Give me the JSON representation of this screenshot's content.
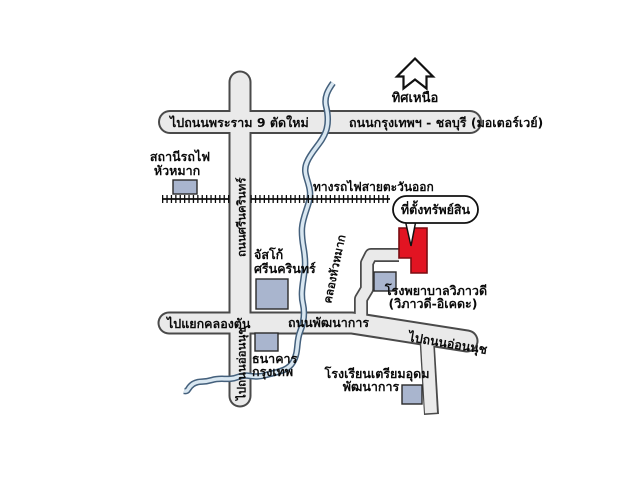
{
  "compass": {
    "label": "ทิศเหนือ"
  },
  "roads": {
    "motorway_left": "ไปถนนพระราม 9 ตัดใหม่",
    "motorway_right": "ถนนกรุงเทพฯ - ชลบุรี (มอเตอร์เวย์)",
    "srinakarin": "ถนนศรีนครินทร์",
    "to_khlong_tan": "ไปแยกคลองตัน",
    "phatthanakan": "ถนนพัฒนาการ",
    "to_on_nut_east": "ไปถนนอ่อนนุช",
    "to_on_nut_south": "ไปถนนอ่อนนุช"
  },
  "railway": {
    "label": "ทางรถไฟสายตะวันออก"
  },
  "canal": {
    "label": "คลองหัวหมาก"
  },
  "landmarks": {
    "train_station": {
      "line1": "สถานีรถไฟ",
      "line2": "หัวหมาก"
    },
    "jusco": {
      "line1": "จัสโก้",
      "line2": "ศรีนครินทร์"
    },
    "bangkok_bank": {
      "line1": "ธนาคาร",
      "line2": "กรุงเทพ"
    },
    "hospital": {
      "line1": "โรงพยาบาลวิภาวดี",
      "line2": "(วิภาวดี-อิเคดะ)"
    },
    "school": {
      "line1": "โรงเรียนเตรียมอุดม",
      "line2": "พัฒนาการ"
    }
  },
  "property": {
    "callout": "ที่ตั้งทรัพย์สิน"
  },
  "colors": {
    "background": "#ffffff",
    "road_fill": "#eaeaea",
    "road_border": "#4a4a4a",
    "railway": "#0d0d0d",
    "canal_fill": "#d9e7f1",
    "canal_border": "#44607c",
    "landmark_fill": "#a9b5ce",
    "landmark_border": "#2a2a2a",
    "property_red": "#e21422",
    "property_border": "#7a0d12"
  }
}
